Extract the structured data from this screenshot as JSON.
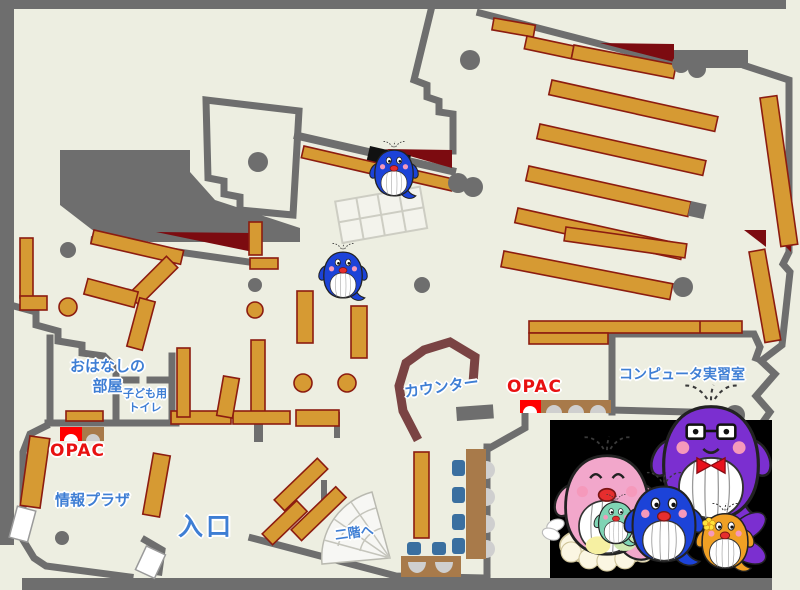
{
  "labels": {
    "storytelling_room": "おはなしの\n部屋",
    "kids_toilet": "子ども用\nトイレ",
    "opac_left": "OPAC",
    "opac_right": "OPAC",
    "info_plaza": "情報プラザ",
    "entrance": "入口",
    "counter": "カウンター",
    "computer_room": "コンピュータ実習室",
    "to_second_floor": "二階へ"
  },
  "colors": {
    "floor": "#edeee1",
    "wall": "#6e6e6e",
    "shelf": "#d69a33",
    "shelf_border": "#8c1c10",
    "dark_red": "#7c0b10",
    "counter": "#7a4343",
    "label_blue": "#3e7ed4",
    "opac_red": "#e81111",
    "bench_brown": "#a87a4a",
    "chair_blue": "#3a6fa0",
    "seat_gray": "#cfcfcf",
    "photo_bg": "#000000",
    "whale_blue": "#1c43d8",
    "whale_pink": "#f2a7cb",
    "whale_purple": "#7b2fd0",
    "whale_orange": "#f0a024",
    "whale_green": "#7fd4b4"
  },
  "icons": {
    "whale_mascot": "blue-whale-mascot",
    "whale_family_photo": "whale-family (pink mother with green baby, blue child, purple father with glasses and bow tie, orange child with flower)",
    "stairs": "fan-shaped-staircase",
    "opac_terminal": "opac-search-terminal",
    "pillar": "building-column"
  }
}
